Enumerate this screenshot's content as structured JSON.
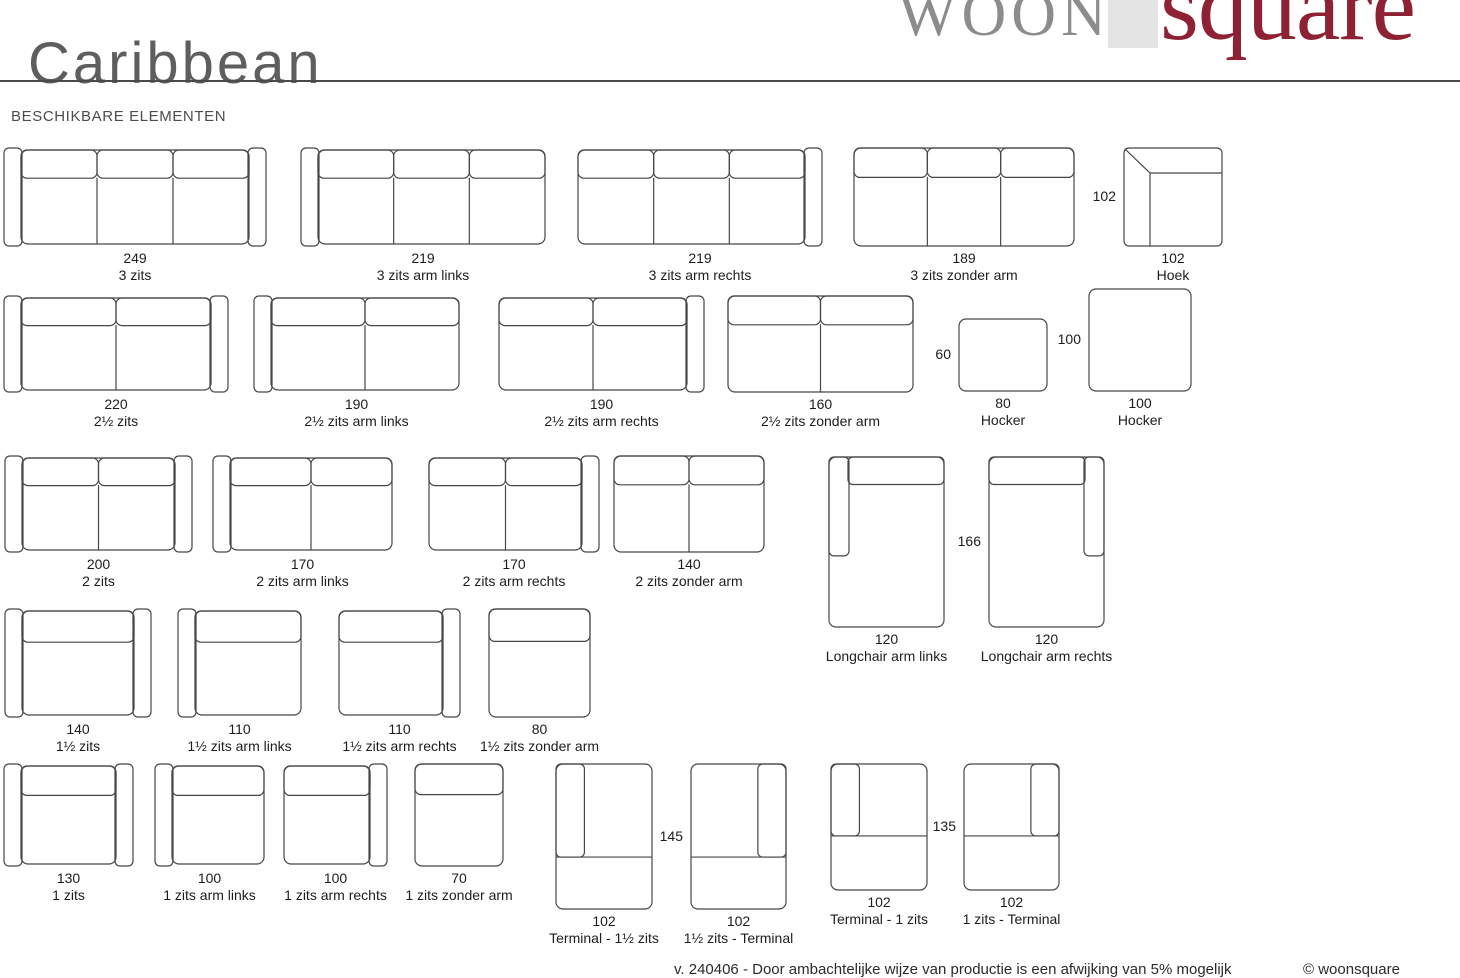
{
  "page": {
    "title": "Caribbean",
    "section_heading": "BESCHIKBARE ELEMENTEN",
    "logo": {
      "part1": "WOON",
      "part2": "square"
    },
    "footer": {
      "note": "v. 240406 - Door ambachtelijke wijze van productie is een afwijking van 5% mogelijk",
      "copyright": "© woonsquare"
    }
  },
  "colors": {
    "brand_red": "#8e2234",
    "logo_gray": "#8c8c8c",
    "logo_box_gray": "#e4e4e4",
    "line_gray": "#474747",
    "text_dark": "#1d1d1d",
    "title_gray": "#5e5e5e"
  },
  "elements": [
    {
      "id": "3-zits",
      "value": "249",
      "label": "3 zits",
      "fig": {
        "kind": "sofa",
        "arms": "both",
        "sections": 3
      },
      "pos": {
        "x": 3,
        "y": 147
      },
      "size": {
        "w": 264,
        "h": 100
      }
    },
    {
      "id": "3-zits-arm-links",
      "value": "219",
      "label": "3 zits arm links",
      "fig": {
        "kind": "sofa",
        "arms": "left",
        "sections": 3
      },
      "pos": {
        "x": 300,
        "y": 147
      },
      "size": {
        "w": 246,
        "h": 100
      }
    },
    {
      "id": "3-zits-arm-rechts",
      "value": "219",
      "label": "3 zits arm rechts",
      "fig": {
        "kind": "sofa",
        "arms": "right",
        "sections": 3
      },
      "pos": {
        "x": 577,
        "y": 147
      },
      "size": {
        "w": 246,
        "h": 100
      }
    },
    {
      "id": "3-zits-zonder-arm",
      "value": "189",
      "label": "3 zits zonder arm",
      "fig": {
        "kind": "sofa",
        "arms": "none",
        "sections": 3
      },
      "pos": {
        "x": 853,
        "y": 147
      },
      "size": {
        "w": 222,
        "h": 100
      }
    },
    {
      "id": "hoek",
      "value": "102",
      "label": "Hoek",
      "side_label": {
        "text": "102"
      },
      "fig": {
        "kind": "corner"
      },
      "pos": {
        "x": 1123,
        "y": 147
      },
      "size": {
        "w": 100,
        "h": 100
      }
    },
    {
      "id": "2half-zits",
      "value": "220",
      "label": "2½ zits",
      "fig": {
        "kind": "sofa",
        "arms": "both",
        "sections": 2
      },
      "pos": {
        "x": 3,
        "y": 295
      },
      "size": {
        "w": 226,
        "h": 98
      }
    },
    {
      "id": "2half-zits-arm-links",
      "value": "190",
      "label": "2½ zits arm links",
      "fig": {
        "kind": "sofa",
        "arms": "left",
        "sections": 2
      },
      "pos": {
        "x": 253,
        "y": 295
      },
      "size": {
        "w": 207,
        "h": 98
      }
    },
    {
      "id": "2half-zits-arm-rechts",
      "value": "190",
      "label": "2½ zits arm rechts",
      "fig": {
        "kind": "sofa",
        "arms": "right",
        "sections": 2
      },
      "pos": {
        "x": 498,
        "y": 295
      },
      "size": {
        "w": 207,
        "h": 98
      }
    },
    {
      "id": "2half-zits-zonder-arm",
      "value": "160",
      "label": "2½ zits zonder arm",
      "fig": {
        "kind": "sofa",
        "arms": "none",
        "sections": 2
      },
      "pos": {
        "x": 727,
        "y": 295
      },
      "size": {
        "w": 187,
        "h": 98
      }
    },
    {
      "id": "hocker-80",
      "value": "80",
      "label": "Hocker",
      "side_label": {
        "text": "60"
      },
      "fig": {
        "kind": "hocker"
      },
      "pos": {
        "x": 958,
        "y": 318
      },
      "size": {
        "w": 90,
        "h": 74
      }
    },
    {
      "id": "hocker-100",
      "value": "100",
      "label": "Hocker",
      "side_label": {
        "text": "100"
      },
      "fig": {
        "kind": "hocker"
      },
      "pos": {
        "x": 1088,
        "y": 288
      },
      "size": {
        "w": 104,
        "h": 104
      }
    },
    {
      "id": "2-zits",
      "value": "200",
      "label": "2 zits",
      "fig": {
        "kind": "sofa",
        "arms": "both",
        "sections": 2
      },
      "pos": {
        "x": 4,
        "y": 455
      },
      "size": {
        "w": 189,
        "h": 98
      }
    },
    {
      "id": "2-zits-arm-links",
      "value": "170",
      "label": "2 zits arm links",
      "fig": {
        "kind": "sofa",
        "arms": "left",
        "sections": 2
      },
      "pos": {
        "x": 212,
        "y": 455
      },
      "size": {
        "w": 181,
        "h": 98
      }
    },
    {
      "id": "2-zits-arm-rechts",
      "value": "170",
      "label": "2 zits arm rechts",
      "fig": {
        "kind": "sofa",
        "arms": "right",
        "sections": 2
      },
      "pos": {
        "x": 428,
        "y": 455
      },
      "size": {
        "w": 172,
        "h": 98
      }
    },
    {
      "id": "2-zits-zonder-arm",
      "value": "140",
      "label": "2 zits zonder arm",
      "fig": {
        "kind": "sofa",
        "arms": "none",
        "sections": 2
      },
      "pos": {
        "x": 613,
        "y": 455
      },
      "size": {
        "w": 152,
        "h": 98
      }
    },
    {
      "id": "longchair-arm-links",
      "value": "120",
      "label": "Longchair arm links",
      "fig": {
        "kind": "longchair",
        "side": "left"
      },
      "pos": {
        "x": 828,
        "y": 456
      },
      "size": {
        "w": 117,
        "h": 172
      }
    },
    {
      "id": "longchair-arm-rechts",
      "value": "120",
      "label": "Longchair arm rechts",
      "side_label": {
        "text": "166"
      },
      "fig": {
        "kind": "longchair",
        "side": "right"
      },
      "pos": {
        "x": 988,
        "y": 456
      },
      "size": {
        "w": 117,
        "h": 172
      }
    },
    {
      "id": "1half-zits",
      "value": "140",
      "label": "1½ zits",
      "fig": {
        "kind": "sofa",
        "arms": "both",
        "sections": 1
      },
      "pos": {
        "x": 4,
        "y": 608
      },
      "size": {
        "w": 148,
        "h": 110
      }
    },
    {
      "id": "1half-zits-arm-links",
      "value": "110",
      "label": "1½ zits arm links",
      "fig": {
        "kind": "sofa",
        "arms": "left",
        "sections": 1
      },
      "pos": {
        "x": 177,
        "y": 608
      },
      "size": {
        "w": 125,
        "h": 110
      }
    },
    {
      "id": "1half-zits-arm-rechts",
      "value": "110",
      "label": "1½ zits arm rechts",
      "fig": {
        "kind": "sofa",
        "arms": "right",
        "sections": 1
      },
      "pos": {
        "x": 338,
        "y": 608
      },
      "size": {
        "w": 123,
        "h": 110
      }
    },
    {
      "id": "1half-zits-zonder-arm",
      "value": "80",
      "label": "1½ zits zonder arm",
      "fig": {
        "kind": "sofa",
        "arms": "none",
        "sections": 1
      },
      "pos": {
        "x": 488,
        "y": 608
      },
      "size": {
        "w": 103,
        "h": 110
      }
    },
    {
      "id": "1-zits",
      "value": "130",
      "label": "1 zits",
      "fig": {
        "kind": "sofa",
        "arms": "both",
        "sections": 1
      },
      "pos": {
        "x": 3,
        "y": 763
      },
      "size": {
        "w": 131,
        "h": 104
      }
    },
    {
      "id": "1-zits-arm-links",
      "value": "100",
      "label": "1 zits arm links",
      "fig": {
        "kind": "sofa",
        "arms": "left",
        "sections": 1
      },
      "pos": {
        "x": 154,
        "y": 763
      },
      "size": {
        "w": 111,
        "h": 104
      }
    },
    {
      "id": "1-zits-arm-rechts",
      "value": "100",
      "label": "1 zits arm rechts",
      "fig": {
        "kind": "sofa",
        "arms": "right",
        "sections": 1
      },
      "pos": {
        "x": 283,
        "y": 763
      },
      "size": {
        "w": 105,
        "h": 104
      }
    },
    {
      "id": "1-zits-zonder-arm",
      "value": "70",
      "label": "1 zits zonder arm",
      "fig": {
        "kind": "sofa",
        "arms": "none",
        "sections": 1
      },
      "pos": {
        "x": 414,
        "y": 763
      },
      "size": {
        "w": 90,
        "h": 104
      }
    },
    {
      "id": "terminal-1half-zits",
      "value": "102",
      "label": "Terminal - 1½ zits",
      "fig": {
        "kind": "terminal",
        "side": "left",
        "line": 0.64
      },
      "pos": {
        "x": 555,
        "y": 763
      },
      "size": {
        "w": 98,
        "h": 147
      }
    },
    {
      "id": "1half-zits-terminal",
      "value": "102",
      "label": "1½ zits - Terminal",
      "side_label": {
        "text": "145"
      },
      "fig": {
        "kind": "terminal",
        "side": "right",
        "line": 0.64
      },
      "pos": {
        "x": 690,
        "y": 763
      },
      "size": {
        "w": 97,
        "h": 147
      }
    },
    {
      "id": "terminal-1-zits",
      "value": "102",
      "label": "Terminal - 1 zits",
      "fig": {
        "kind": "terminal",
        "side": "left",
        "line": 0.57
      },
      "pos": {
        "x": 830,
        "y": 763
      },
      "size": {
        "w": 98,
        "h": 128
      }
    },
    {
      "id": "1-zits-terminal",
      "value": "102",
      "label": "1 zits - Terminal",
      "side_label": {
        "text": "135"
      },
      "fig": {
        "kind": "terminal",
        "side": "right",
        "line": 0.57
      },
      "pos": {
        "x": 963,
        "y": 763
      },
      "size": {
        "w": 97,
        "h": 128
      }
    }
  ]
}
